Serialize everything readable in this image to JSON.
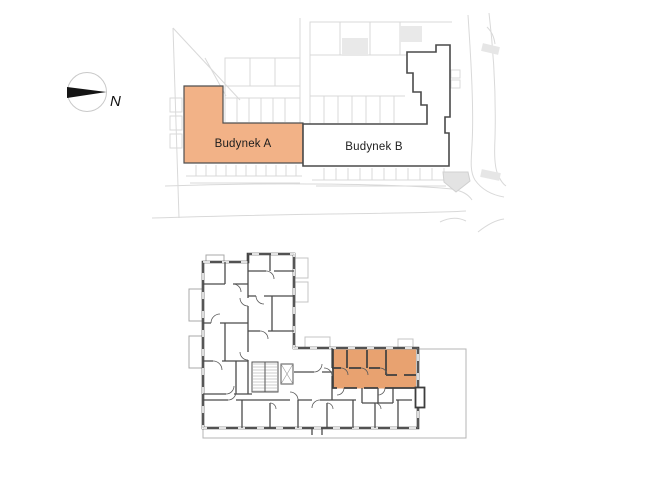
{
  "site_plan": {
    "building_a": {
      "label": "Budynek A",
      "fill": "#f2b287",
      "border": "#4f4f4f"
    },
    "building_b": {
      "label": "Budynek B",
      "fill": "#ffffff",
      "border": "#4a4a4a"
    },
    "compass": {
      "label": "N"
    }
  },
  "floor_plan": {
    "highlighted_unit": {
      "fill": "#e8a270"
    },
    "wall_color": "#3d3d3d",
    "property_line_color": "#b5b5b5"
  },
  "text_color": "#1d1d1d"
}
